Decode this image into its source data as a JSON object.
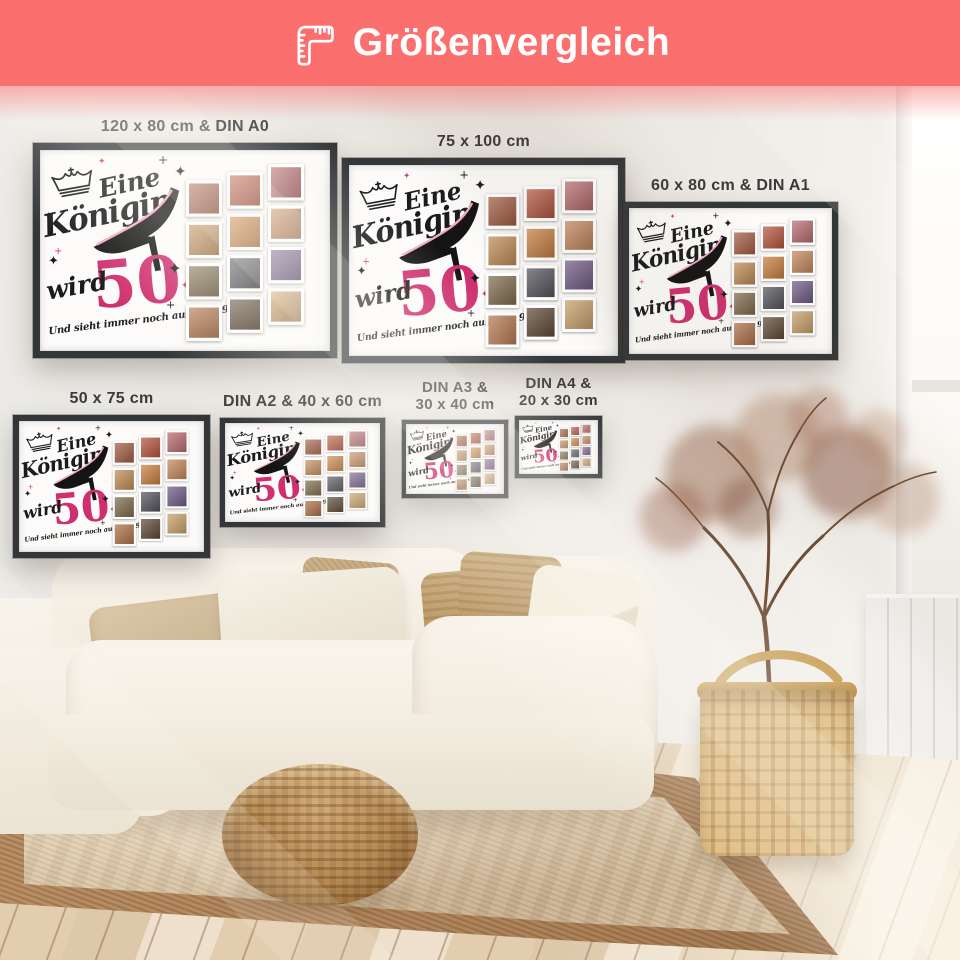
{
  "header": {
    "title": "Größenvergleich",
    "icon": "folding-ruler-icon",
    "background_color": "#FB6F6F",
    "text_color": "#FFFFFF"
  },
  "poster_design": {
    "word_top": "Eine",
    "word_main": "Königin",
    "word_small": "wird",
    "number": "50",
    "tagline": "Und sieht immer noch aus wie 29",
    "accent_color": "#CF2F6E",
    "ink_color": "#1B1B1D",
    "paper_color": "#FCFBF9",
    "frame_color": "#34373A",
    "photo_colors": [
      "#a35a40",
      "#c08a54",
      "#7d6a4a",
      "#b07047",
      "#b5533c",
      "#c87e3e",
      "#53525a",
      "#5c4734",
      "#b86a6e",
      "#c3865a",
      "#6f5a86",
      "#c9a06a"
    ]
  },
  "posters": [
    {
      "label": "120 x 80 cm & DIN A0"
    },
    {
      "label": "75 x 100 cm"
    },
    {
      "label": "60 x 80 cm & DIN A1"
    },
    {
      "label": "50 x 75 cm"
    },
    {
      "label": "DIN A2 & 40 x 60 cm"
    },
    {
      "label": "DIN A3 &\n30 x 40 cm"
    },
    {
      "label": "DIN A4 &\n20 x 30 cm"
    }
  ]
}
